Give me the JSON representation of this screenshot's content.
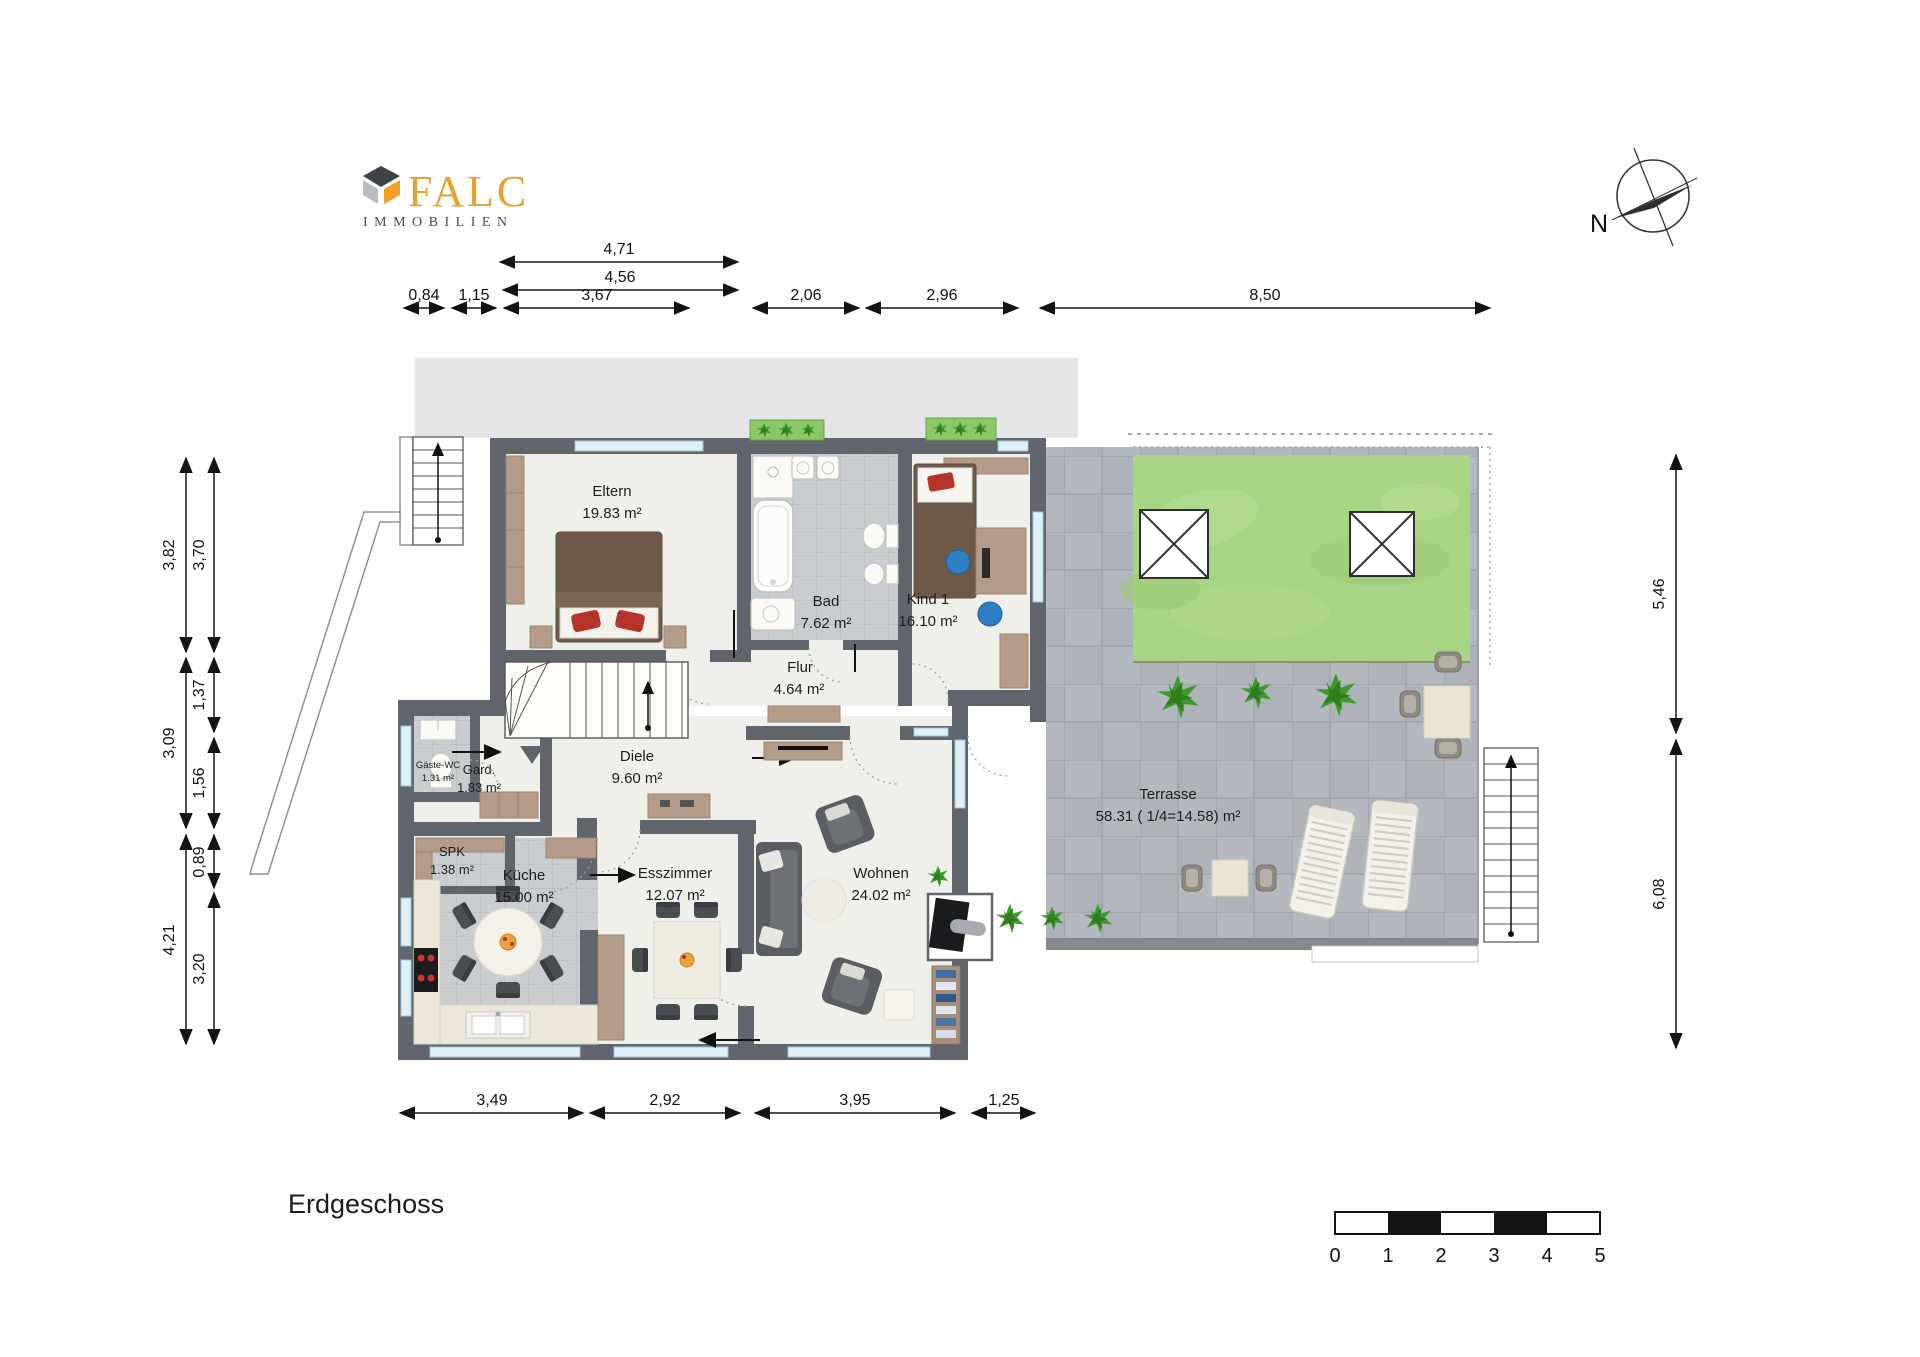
{
  "brand": {
    "name": "FALC",
    "subtitle": "IMMOBILIEN"
  },
  "plan": {
    "title": "Erdgeschoss",
    "compass": "N"
  },
  "rooms": [
    {
      "name": "Eltern",
      "area": "19.83 m²"
    },
    {
      "name": "Bad",
      "area": "7.62 m²"
    },
    {
      "name": "Kind 1",
      "area": "16.10 m²"
    },
    {
      "name": "Flur",
      "area": "4.64 m²"
    },
    {
      "name": "Diele",
      "area": "9.60 m²"
    },
    {
      "name": "Gäste-WC",
      "area": "1.31 m²"
    },
    {
      "name": "Gard.",
      "area": "1.83 m²"
    },
    {
      "name": "SPK",
      "area": "1.38 m²"
    },
    {
      "name": "Küche",
      "area": "15.00 m²"
    },
    {
      "name": "Esszimmer",
      "area": "12.07 m²"
    },
    {
      "name": "Wohnen",
      "area": "24.02 m²"
    },
    {
      "name": "Terrasse",
      "area": "58.31 ( 1/4=14.58) m²"
    }
  ],
  "dims": {
    "top": [
      "4,71",
      "4,56",
      "0,84",
      "1,15",
      "3,67",
      "2,06",
      "2,96",
      "8,50"
    ],
    "left_outer": [
      "3,82",
      "3,09",
      "4,21"
    ],
    "left_inner": [
      "3,70",
      "1,37",
      "1,56",
      "0,89",
      "3,20"
    ],
    "right": [
      "5,46",
      "6,08"
    ],
    "bottom": [
      "3,49",
      "2,92",
      "3,95",
      "1,25"
    ]
  },
  "scale_bar": {
    "ticks": [
      "0",
      "1",
      "2",
      "3",
      "4",
      "5"
    ]
  },
  "colors": {
    "brand_orange": "#F0A024",
    "wall": "#60656D",
    "lawn": "#A8D584",
    "terrace": "#B4B9BF",
    "window": "#DFF0F8"
  }
}
